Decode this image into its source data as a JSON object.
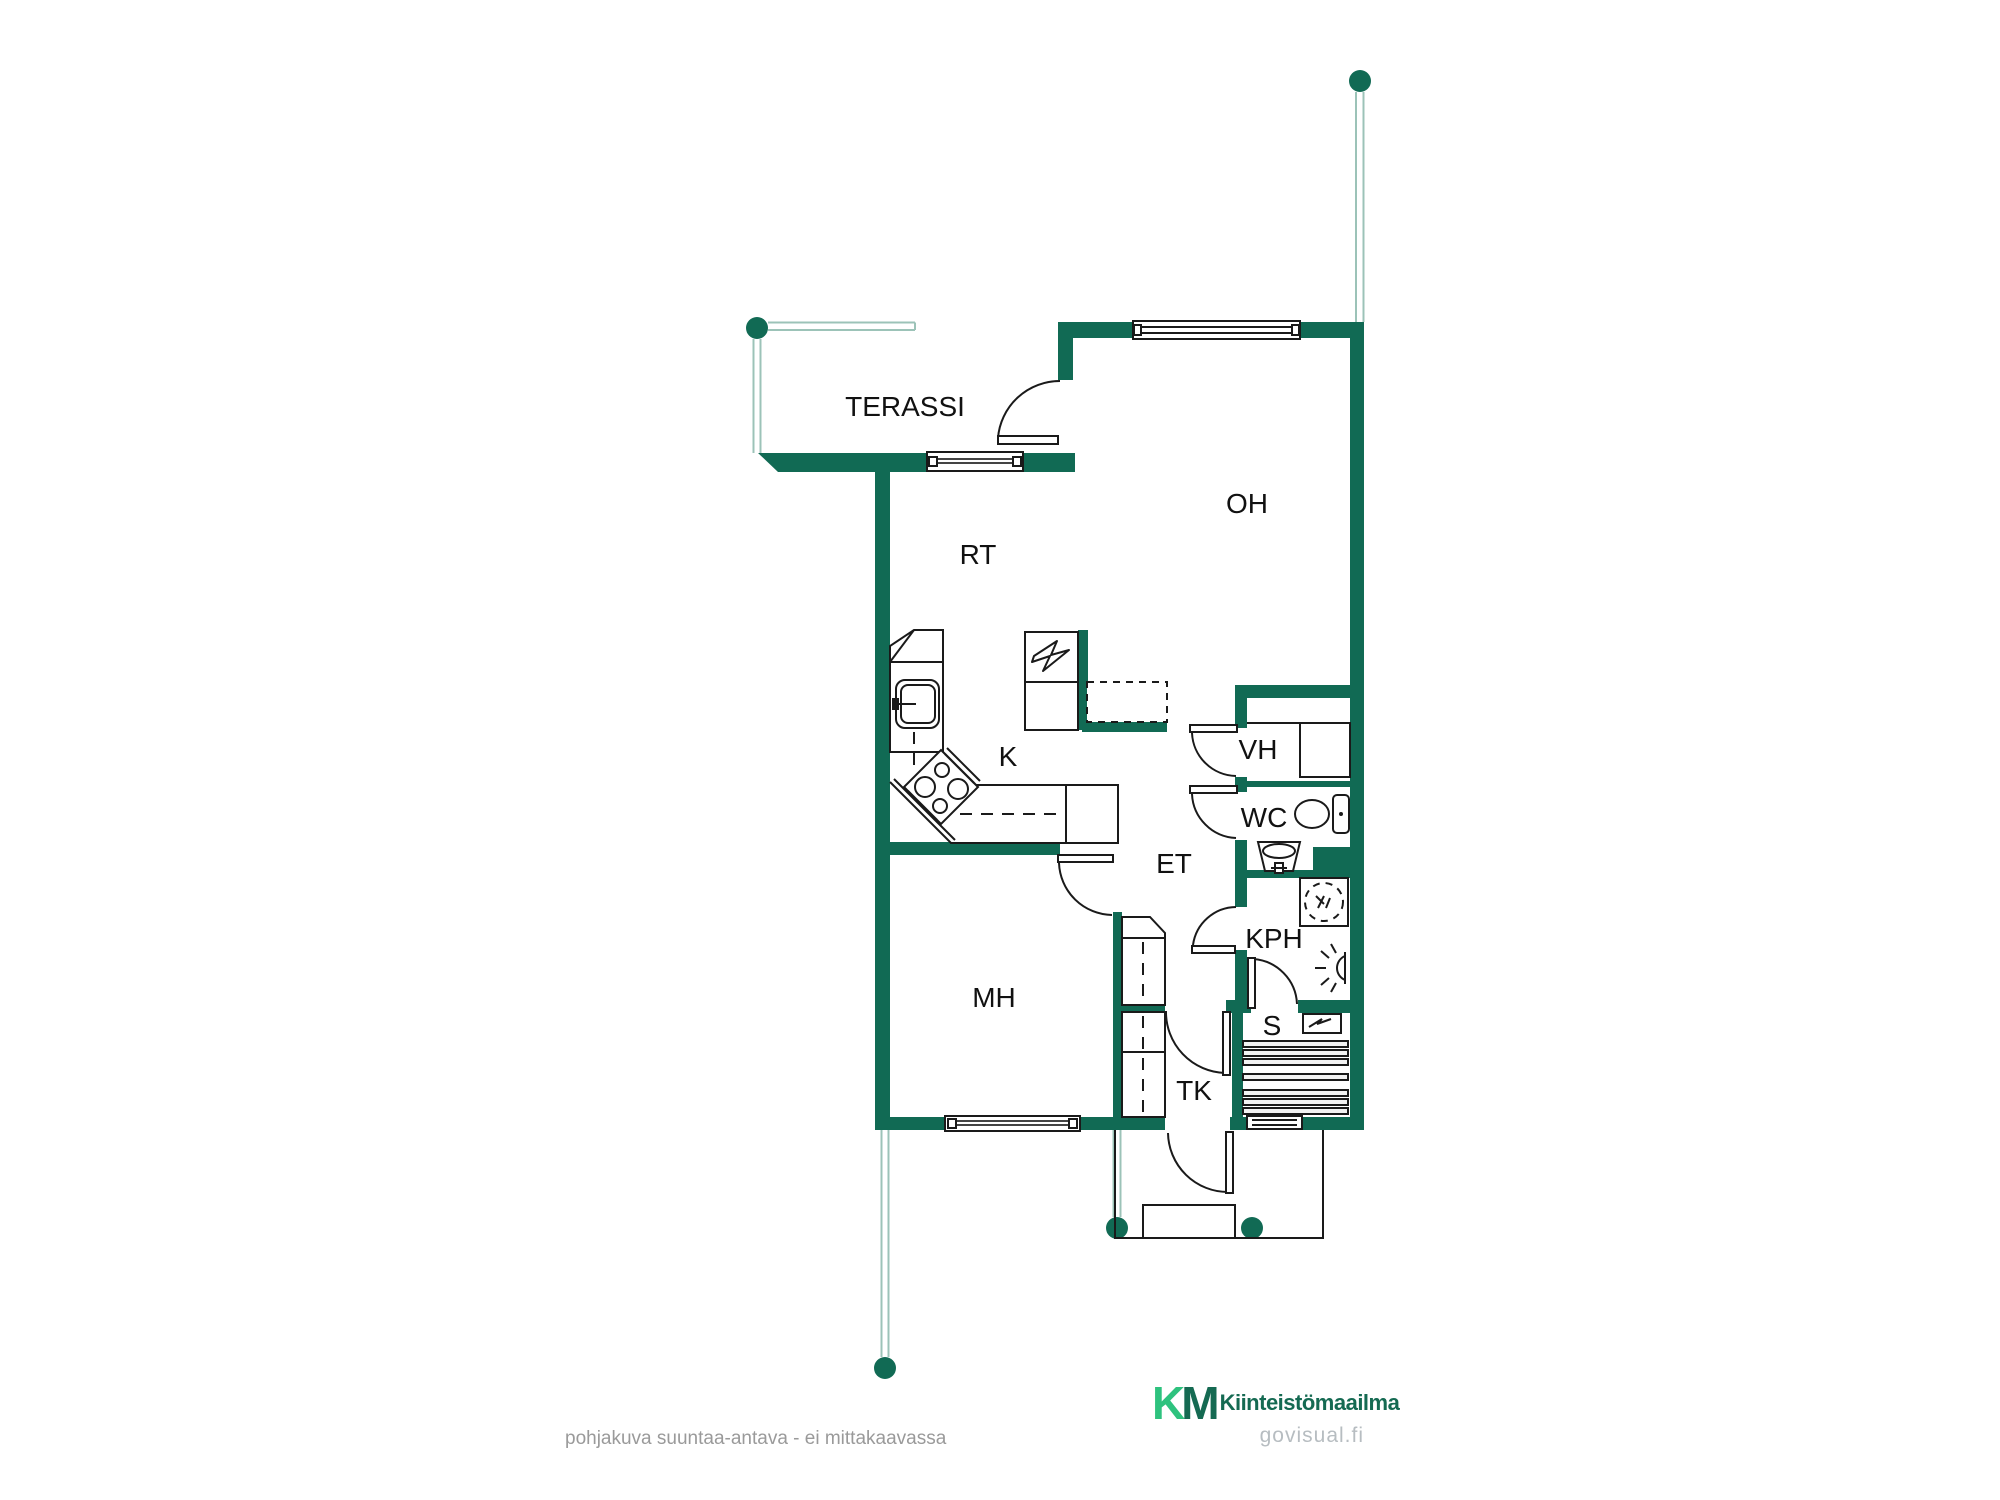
{
  "title": "floor-plan",
  "rooms": {
    "terassi": "TERASSI",
    "oh": "OH",
    "rt": "RT",
    "k": "K",
    "vh": "VH",
    "wc": "WC",
    "et": "ET",
    "kph": "KPH",
    "mh": "MH",
    "s": "S",
    "tk": "TK"
  },
  "footer": {
    "disclaimer": "pohjakuva suuntaa-antava - ei mittakaavassa",
    "watermark": "govisual.fi"
  },
  "brand": {
    "mark_k": "K",
    "mark_m": "M",
    "name": "Kiinteistömaailma"
  },
  "colors": {
    "wall": "#116a54",
    "guide": "#9cc3b8",
    "line": "#1a1a1a",
    "brand_mint": "#2ec27e",
    "brand_dark": "#156a52",
    "muted": "#9a9a9a",
    "watermark_gray": "#b7bdc1"
  }
}
